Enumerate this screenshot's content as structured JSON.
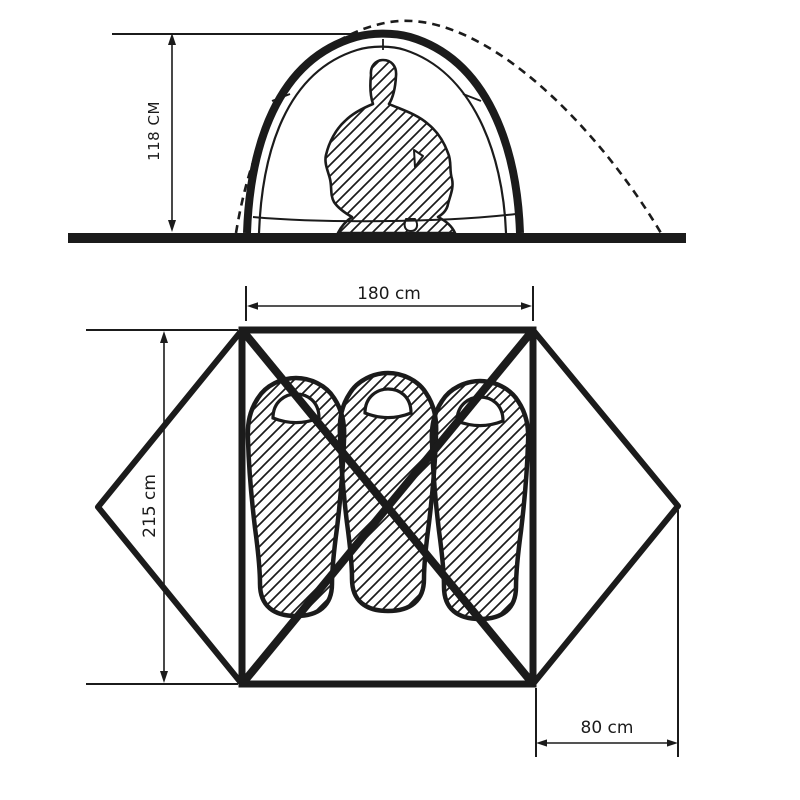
{
  "page": {
    "background": "#ffffff",
    "ink": "#1b1b1b"
  },
  "side_view": {
    "height_dimension": {
      "label": "118 CM",
      "value": 118,
      "unit": "cm"
    }
  },
  "top_view": {
    "width_dimension": {
      "label": "180 cm",
      "value": 180,
      "unit": "cm"
    },
    "length_dimension": {
      "label": "215 cm",
      "value": 215,
      "unit": "cm"
    },
    "vestibule_dimension": {
      "label": "80 cm",
      "value": 80,
      "unit": "cm"
    },
    "sleeping_bag_count": 3
  }
}
